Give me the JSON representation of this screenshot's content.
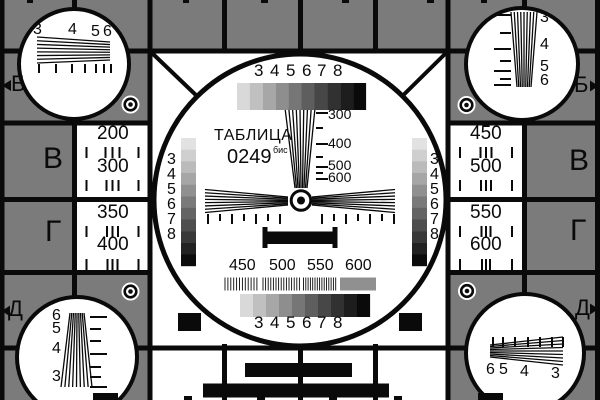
{
  "title": {
    "name": "ТАБЛИЦА",
    "number": "0249",
    "suffix": "бис"
  },
  "edge_markers": {
    "left": [
      "Б",
      "В",
      "Г",
      "Д"
    ],
    "right": [
      "Б",
      "В",
      "Г",
      "Д"
    ]
  },
  "grayscale_labels": [
    "3",
    "4",
    "5",
    "6",
    "7",
    "8"
  ],
  "corner_labels": {
    "top_left": [
      "3",
      "4",
      "5",
      "6"
    ],
    "top_right": [
      "3",
      "4",
      "5",
      "6"
    ],
    "bottom_left": [
      "6",
      "5",
      "4",
      "3"
    ],
    "bottom_right": [
      "6",
      "5",
      "4",
      "3"
    ]
  },
  "resolution_numbers": {
    "left_top": [
      "200",
      "300"
    ],
    "left_bottom": [
      "350",
      "400"
    ],
    "right_top": [
      "450",
      "500"
    ],
    "right_bottom": [
      "550",
      "600"
    ]
  },
  "center_scale_labels": [
    "300",
    "400",
    "500",
    "600"
  ],
  "burst_labels": [
    "450",
    "500",
    "550",
    "600"
  ],
  "colors": {
    "background_gray": "#7b7b7b",
    "line_black": "#0a0a0a",
    "white": "#ffffff",
    "steps_horizontal": [
      "#d9d9d9",
      "#c0c0c0",
      "#a7a7a7",
      "#8e8e8e",
      "#767676",
      "#5e5e5e",
      "#474747",
      "#313131",
      "#1d1d1d",
      "#0a0a0a"
    ],
    "steps_vertical": [
      "#e2e2e2",
      "#cfcfcf",
      "#bbbbbb",
      "#a6a6a6",
      "#909090",
      "#7a7a7a",
      "#646464",
      "#4e4e4e",
      "#383838",
      "#222222",
      "#0c0c0c"
    ]
  }
}
